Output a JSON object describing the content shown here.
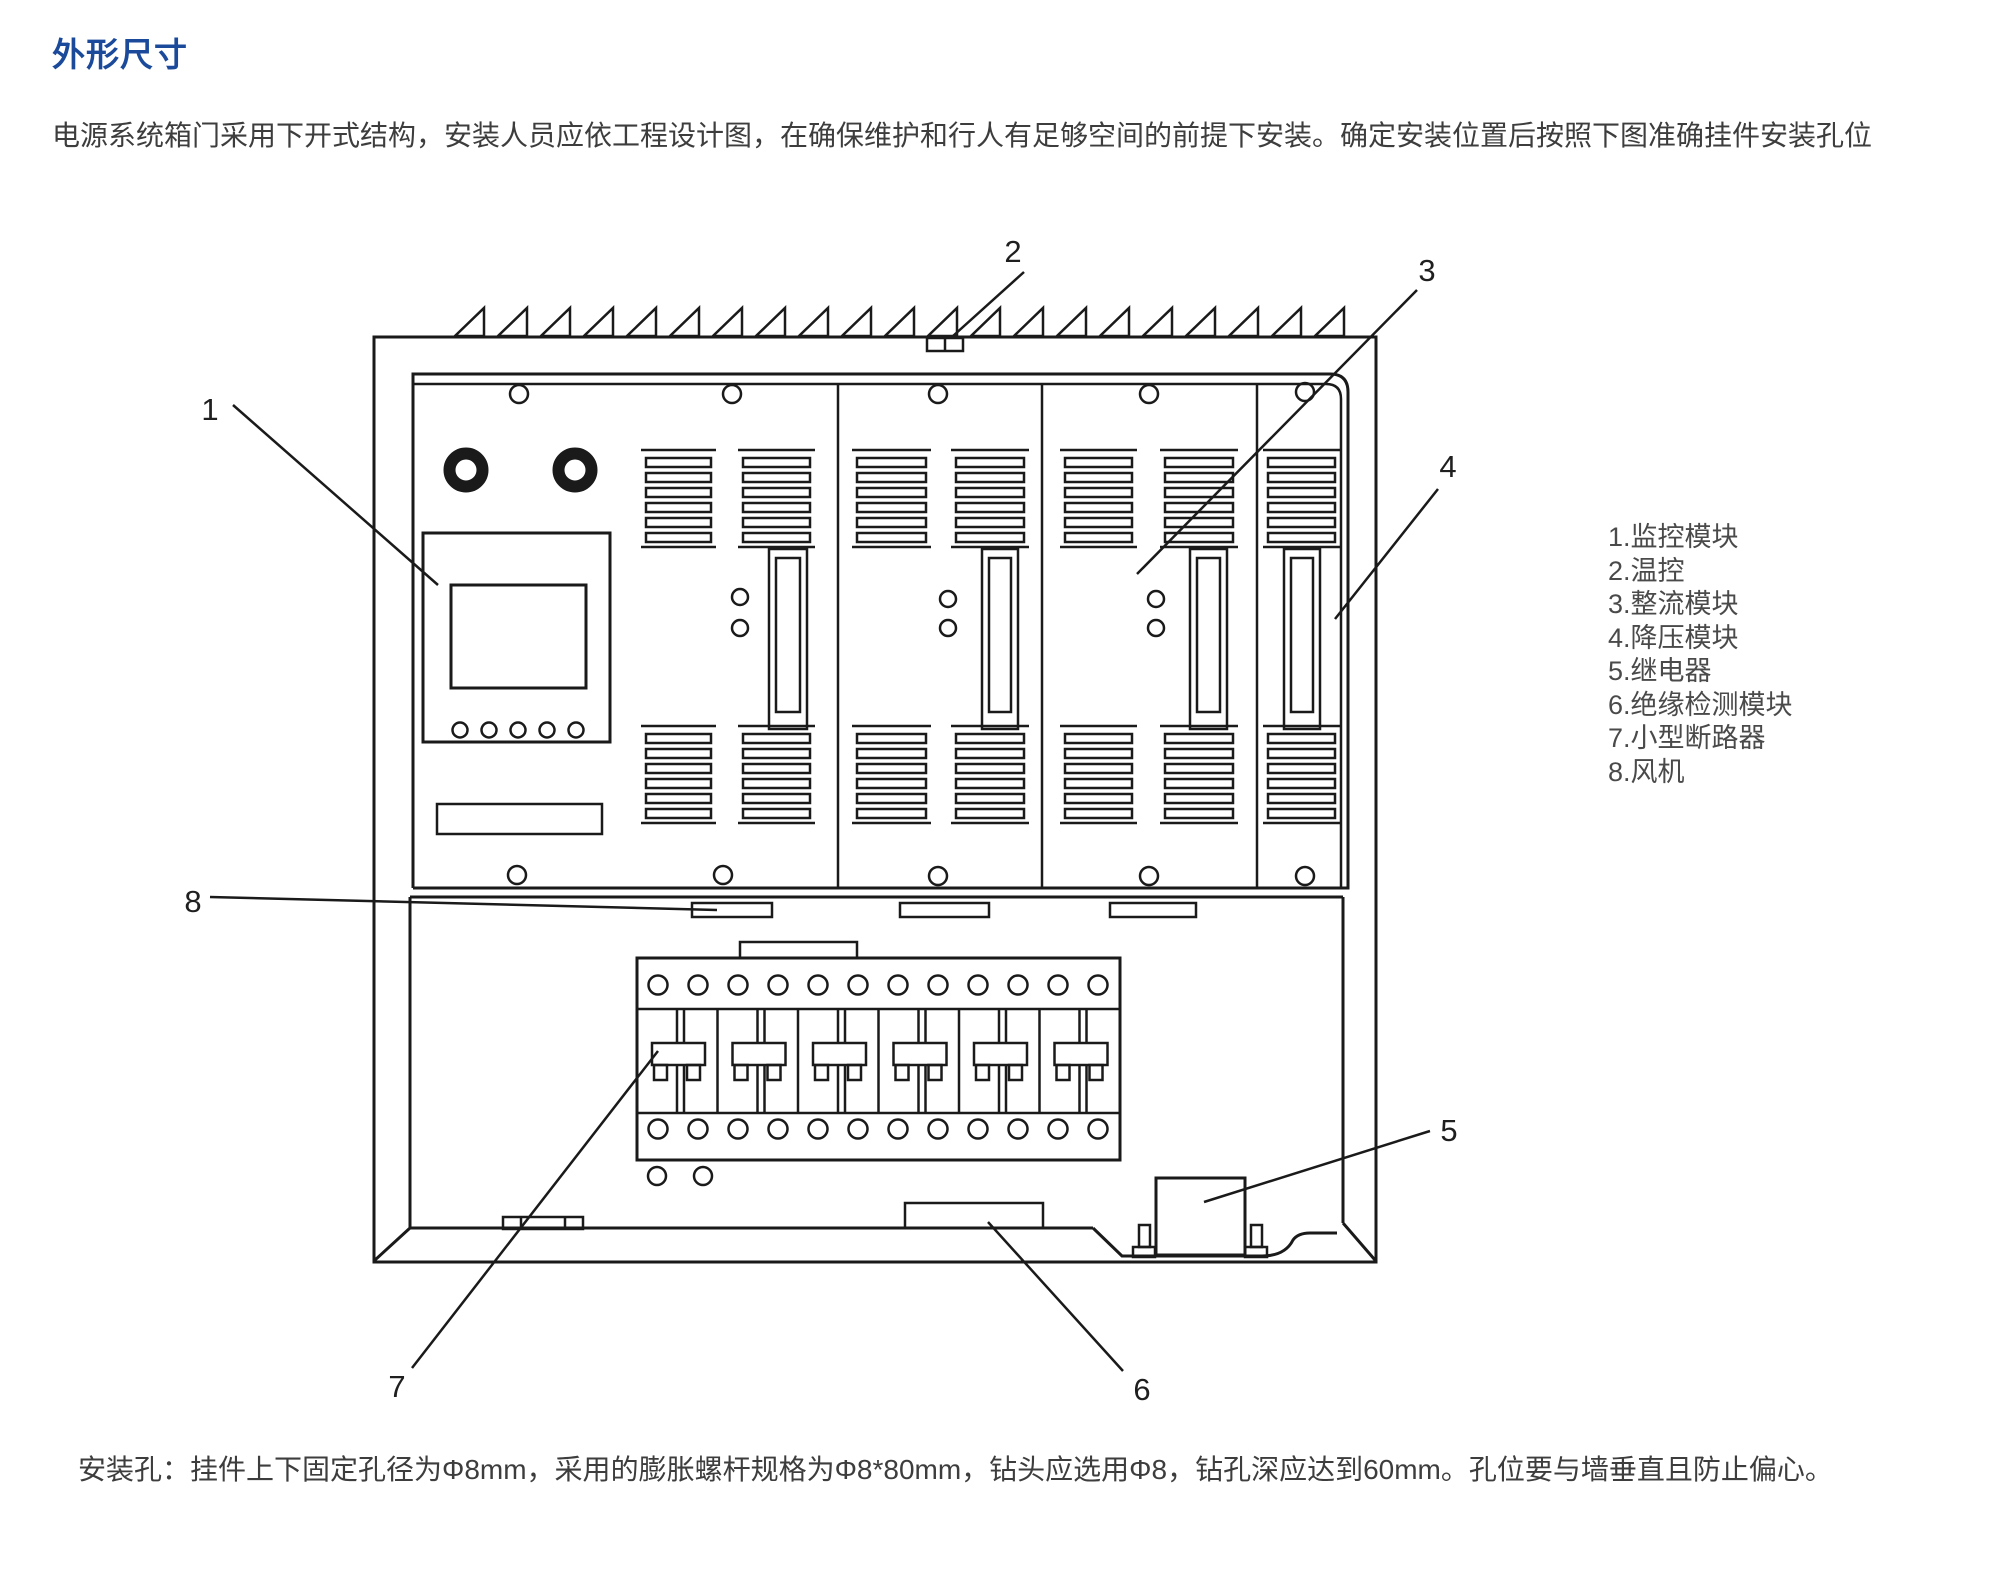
{
  "page": {
    "title": "外形尺寸",
    "intro": "电源系统箱门采用下开式结构，安装人员应依工程设计图，在确保维护和行人有足够空间的前提下安装。确定安装位置后按照下图准确挂件安装孔位",
    "footnote": "安装孔：挂件上下固定孔径为Φ8mm，采用的膨胀螺杆规格为Φ8*80mm，钻头应选用Φ8，钻孔深应达到60mm。孔位要与墙垂直且防止偏心。"
  },
  "colors": {
    "title_blue": "#1b4a9b",
    "body_text": "#3d3d3d",
    "line": "#1a1a1a"
  },
  "legend": {
    "items": [
      "1.监控模块",
      "2.温控",
      "3.整流模块",
      "4.降压模块",
      "5.继电器",
      "6.绝缘检测模块",
      "7.小型断路器",
      "8.风机"
    ]
  },
  "callouts": [
    {
      "num": "1",
      "target": "monitoring-module"
    },
    {
      "num": "2",
      "target": "temperature-control"
    },
    {
      "num": "3",
      "target": "rectifier-module"
    },
    {
      "num": "4",
      "target": "buck-module"
    },
    {
      "num": "5",
      "target": "relay"
    },
    {
      "num": "6",
      "target": "insulation-detection-module"
    },
    {
      "num": "7",
      "target": "mini-circuit-breaker"
    },
    {
      "num": "8",
      "target": "fan"
    }
  ]
}
